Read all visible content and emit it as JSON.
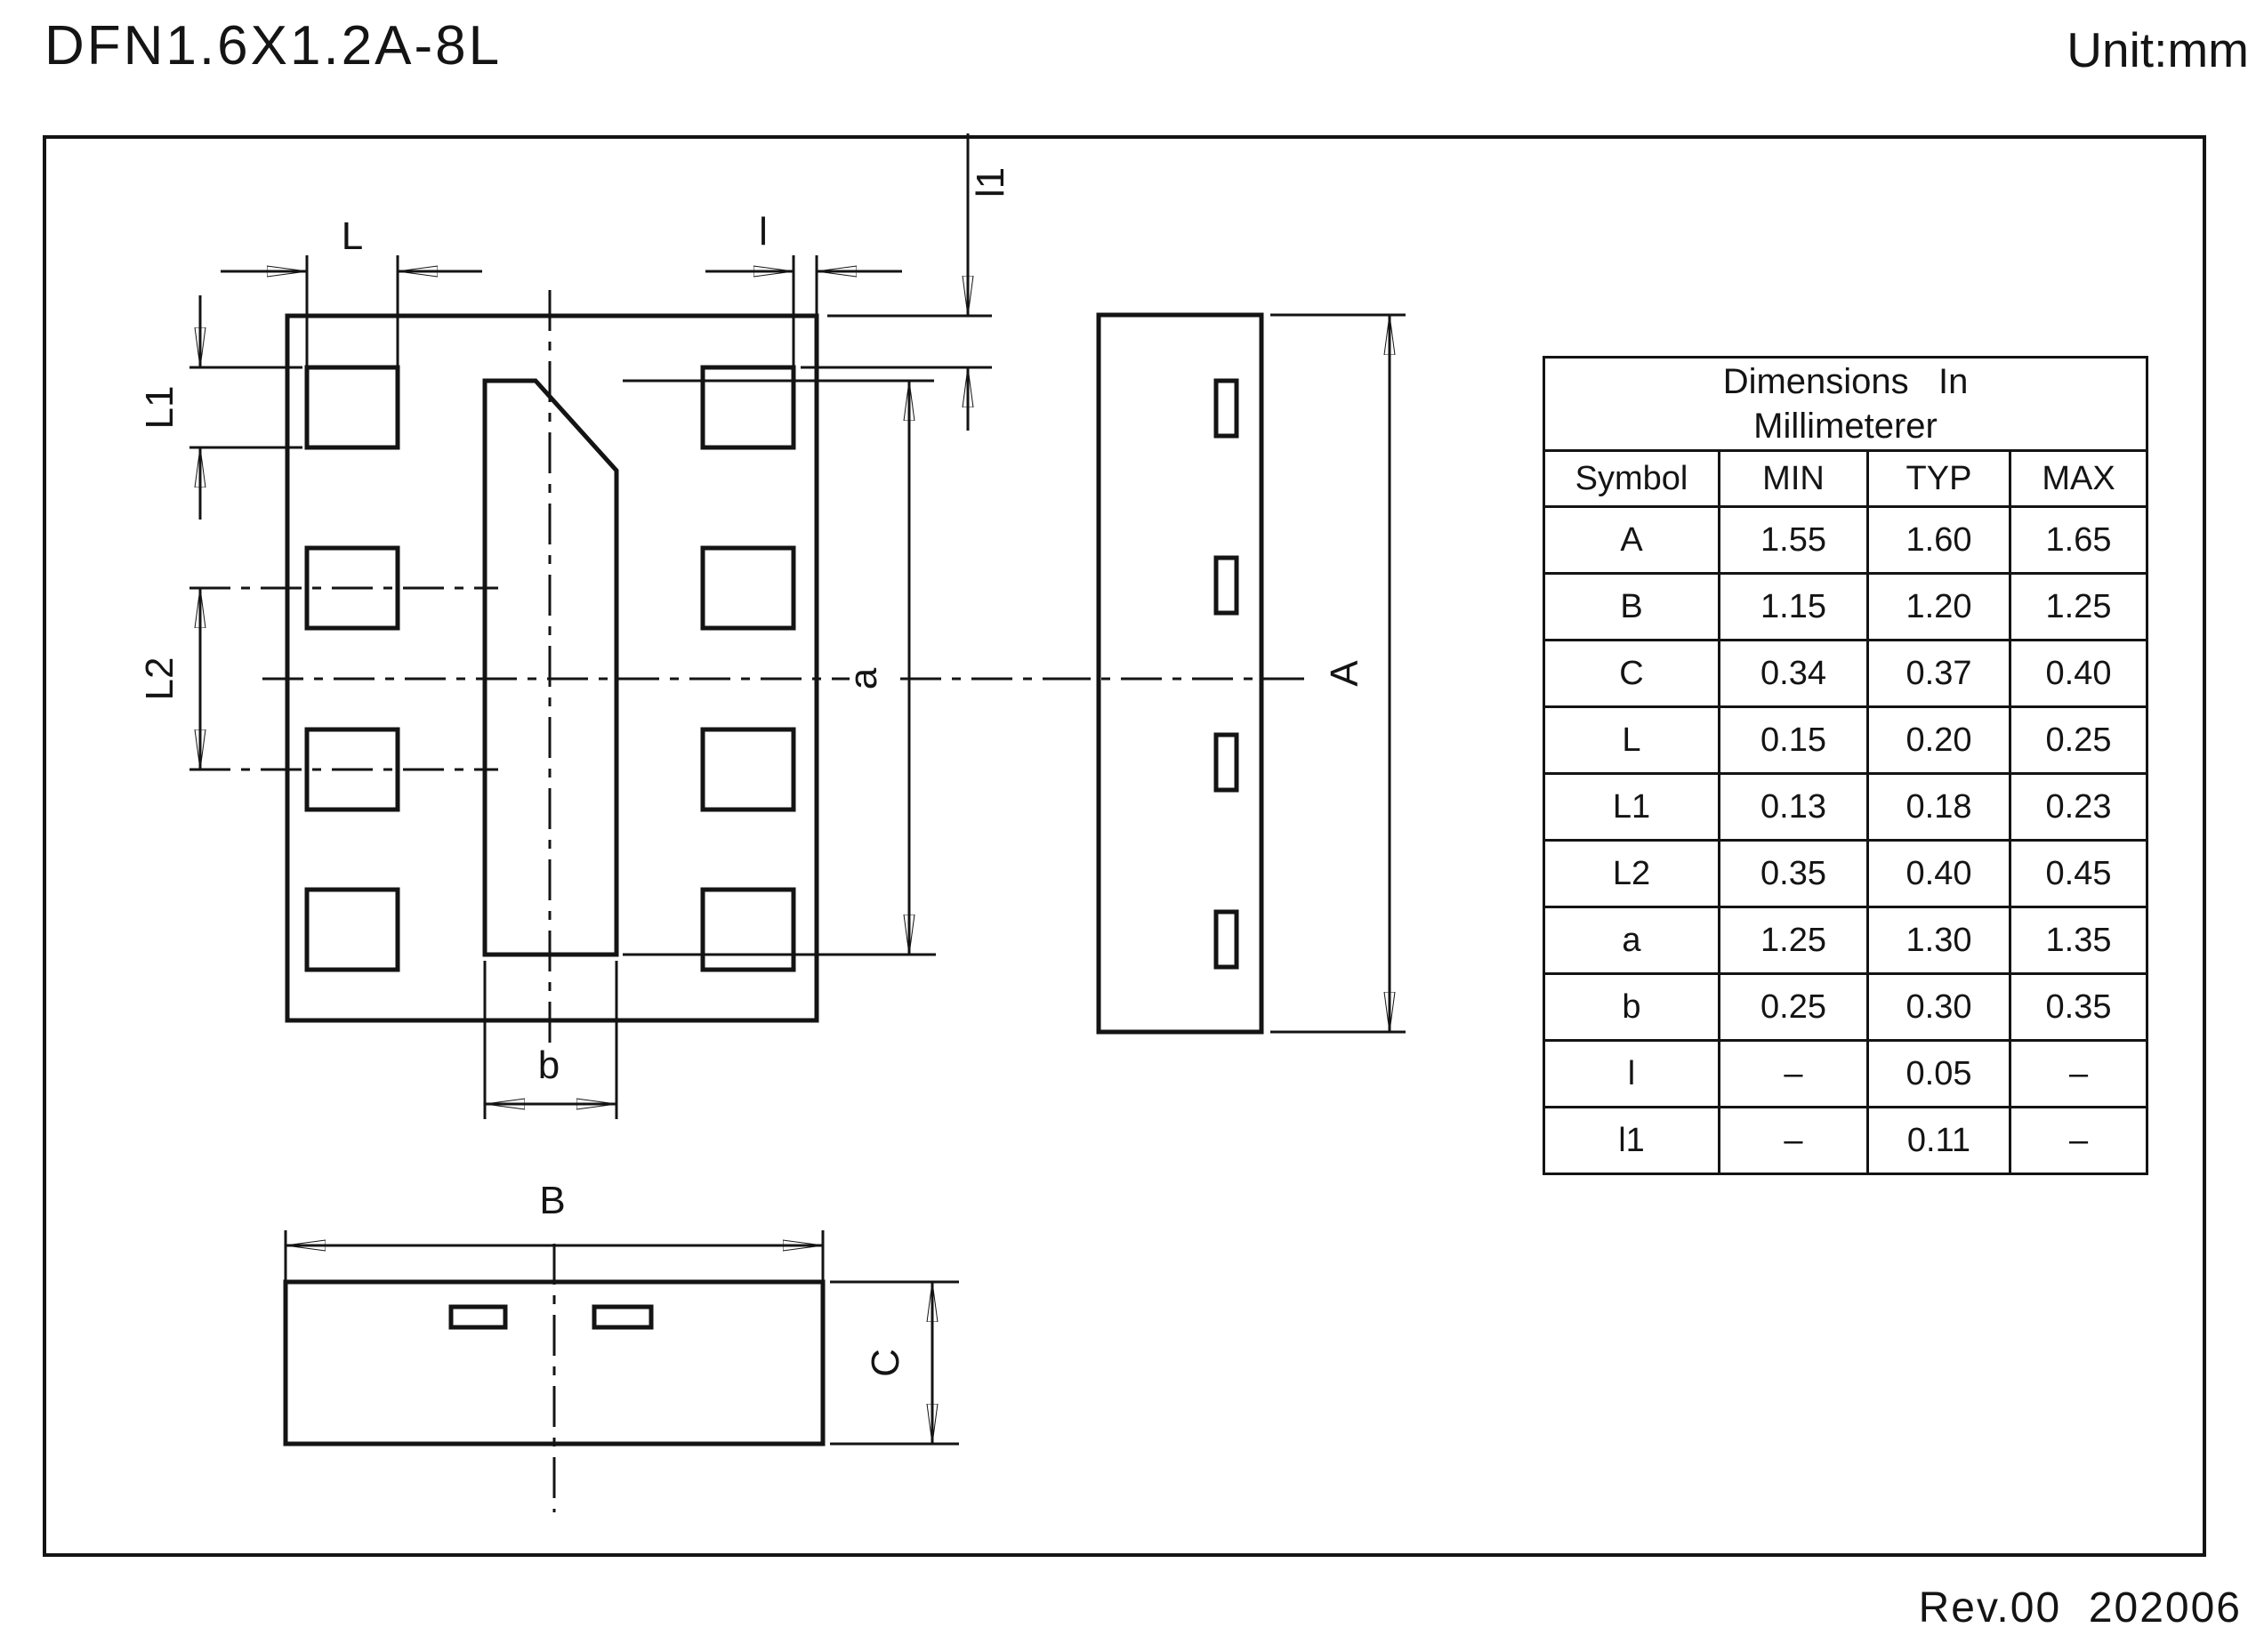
{
  "page": {
    "title": "DFN1.6X1.2A-8L",
    "unit_label": "Unit:mm",
    "revision": "Rev.00  202006"
  },
  "drawing": {
    "labels": {
      "L": "L",
      "l": "l",
      "l1": "l1",
      "L1": "L1",
      "L2": "L2",
      "a": "a",
      "b": "b",
      "A": "A",
      "B": "B",
      "C": "C"
    }
  },
  "table": {
    "caption_line1": "Dimensions   In",
    "caption_line2": "Millimeterer",
    "headers": [
      "Symbol",
      "MIN",
      "TYP",
      "MAX"
    ],
    "rows": [
      {
        "symbol": "A",
        "min": "1.55",
        "typ": "1.60",
        "max": "1.65"
      },
      {
        "symbol": "B",
        "min": "1.15",
        "typ": "1.20",
        "max": "1.25"
      },
      {
        "symbol": "C",
        "min": "0.34",
        "typ": "0.37",
        "max": "0.40"
      },
      {
        "symbol": "L",
        "min": "0.15",
        "typ": "0.20",
        "max": "0.25"
      },
      {
        "symbol": "L1",
        "min": "0.13",
        "typ": "0.18",
        "max": "0.23"
      },
      {
        "symbol": "L2",
        "min": "0.35",
        "typ": "0.40",
        "max": "0.45"
      },
      {
        "symbol": "a",
        "min": "1.25",
        "typ": "1.30",
        "max": "1.35"
      },
      {
        "symbol": "b",
        "min": "0.25",
        "typ": "0.30",
        "max": "0.35"
      },
      {
        "symbol": "l",
        "min": "–",
        "typ": "0.05",
        "max": "–"
      },
      {
        "symbol": "l1",
        "min": "–",
        "typ": "0.11",
        "max": "–"
      }
    ]
  },
  "colors": {
    "ink": "#141414",
    "background": "#ffffff"
  }
}
